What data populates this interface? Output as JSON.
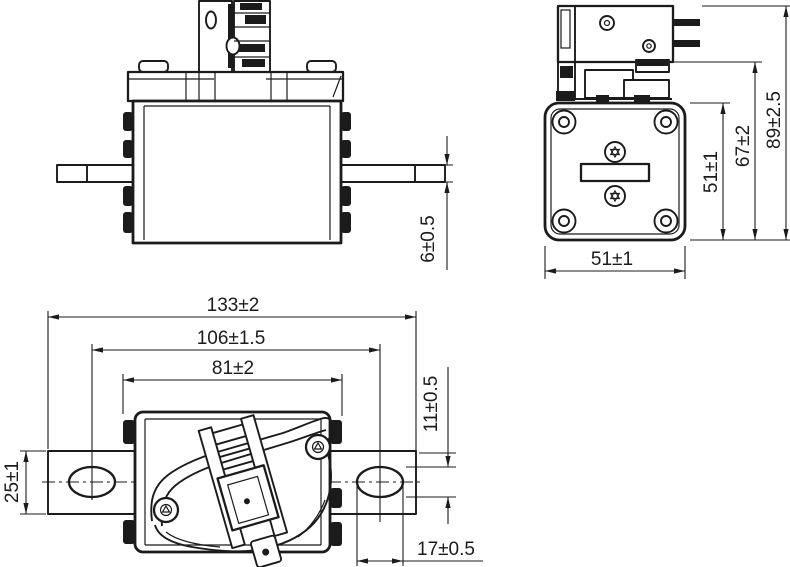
{
  "drawing": {
    "kind": "technical-dimension-drawing",
    "subject": "blade fuse link with microswitch indicator, three orthographic views"
  },
  "colors": {
    "line": "#1b1b1b",
    "background": "#ffffff"
  },
  "dimensions": {
    "blade_thickness": "6±0.5",
    "side_width": "51±1",
    "side_height": "51±1",
    "bracket_height": "67±2",
    "overall_height": "89±2.5",
    "overall_length": "133±2",
    "hole_spacing": "106±1.5",
    "body_length": "81±2",
    "blade_width": "25±1",
    "slot_width": "11±0.5",
    "slot_length": "17±0.5"
  }
}
